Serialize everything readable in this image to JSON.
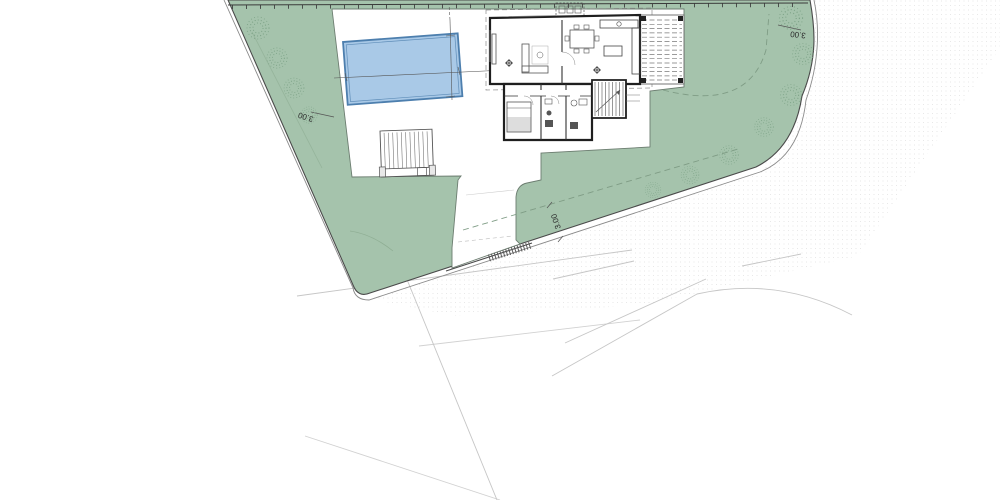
{
  "plan": {
    "type": "architectural-site-plan",
    "labels": {
      "setback_left": "3.00",
      "setback_right": "3.00",
      "setback_bottom": "3.00"
    },
    "colors": {
      "garden_green": "#a5c3ac",
      "tree_green": "#7da387",
      "pool_fill": "#a9c9e7",
      "pool_edge": "#4d7fae",
      "boundary_dark": "#4a4a4a",
      "wall_black": "#1f1f1f",
      "road_gray": "#c6c6c6",
      "paper_white": "#ffffff"
    }
  }
}
